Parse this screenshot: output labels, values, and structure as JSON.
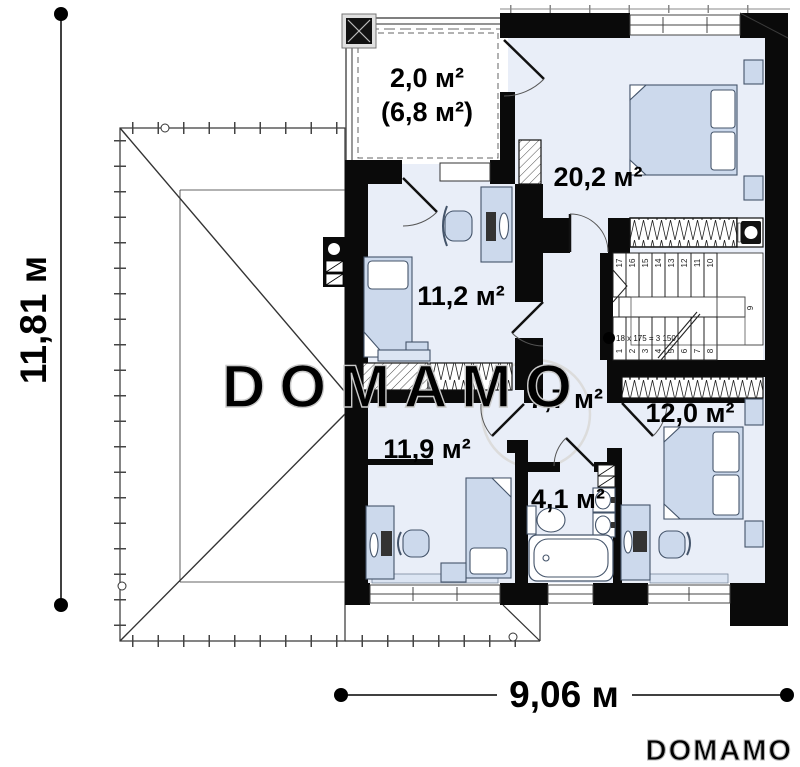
{
  "watermark": {
    "center": "DOMAMO",
    "corner": "DOMAMO"
  },
  "dimensions": {
    "height": "11,81 м",
    "width": "9,06 м"
  },
  "rooms": {
    "balcony": {
      "area": "2,0 м²",
      "area_total": "(6,8 м²)"
    },
    "bedroom_top": {
      "area": "20,2 м²"
    },
    "room_left": {
      "area": "11,2 м²"
    },
    "hallway": {
      "area": "7,7 м²"
    },
    "bedroom_left": {
      "area": "11,9 м²"
    },
    "bathroom": {
      "area": "4,1 м²"
    },
    "bedroom_right": {
      "area": "12,0 м²"
    }
  },
  "stairs": {
    "note": "18 x 175 = 3 150",
    "upper": [
      "17",
      "16",
      "15",
      "14",
      "13",
      "12",
      "11",
      "10"
    ],
    "lower": [
      "1",
      "2",
      "3",
      "4",
      "5",
      "6",
      "7",
      "8"
    ],
    "corner": "9"
  }
}
